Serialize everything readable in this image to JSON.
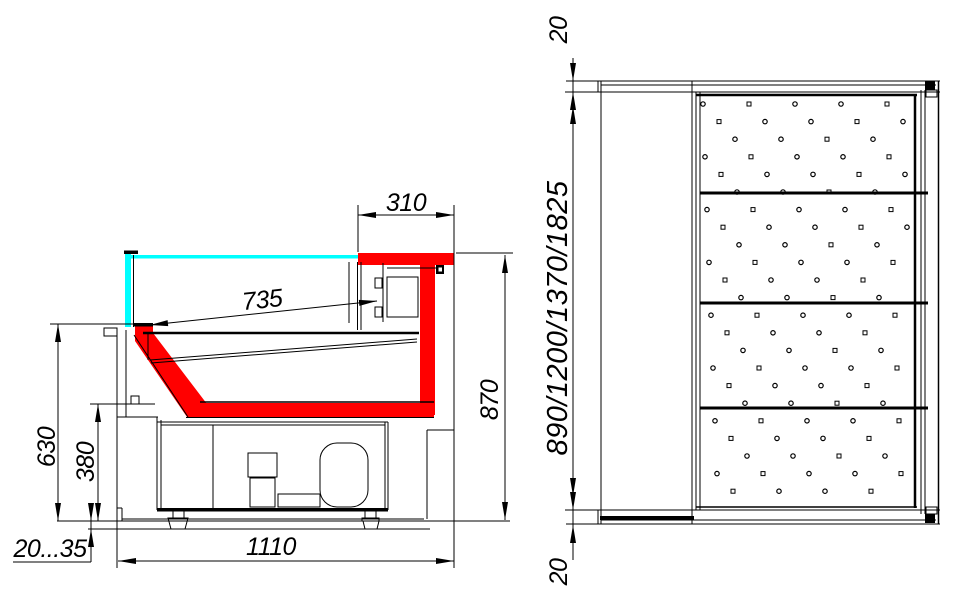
{
  "side_view": {
    "title": "side-section-view",
    "dimensions": {
      "counter_top_width": "310",
      "display_opening_depth": "735",
      "overall_height": "870",
      "front_glass_height": "630",
      "base_section_height": "380",
      "leg_adjustment_range": "20...35",
      "overall_depth": "1110"
    }
  },
  "top_view": {
    "title": "top-plan-view",
    "dimensions": {
      "rear_edge_offset": "20",
      "case_length_options": "890/1200/1370/1825",
      "front_edge_offset": "20"
    }
  },
  "colors": {
    "accent_red": "#ff0000",
    "glass_cyan": "#00ffff",
    "line_black": "#000000",
    "background": "#ffffff"
  }
}
